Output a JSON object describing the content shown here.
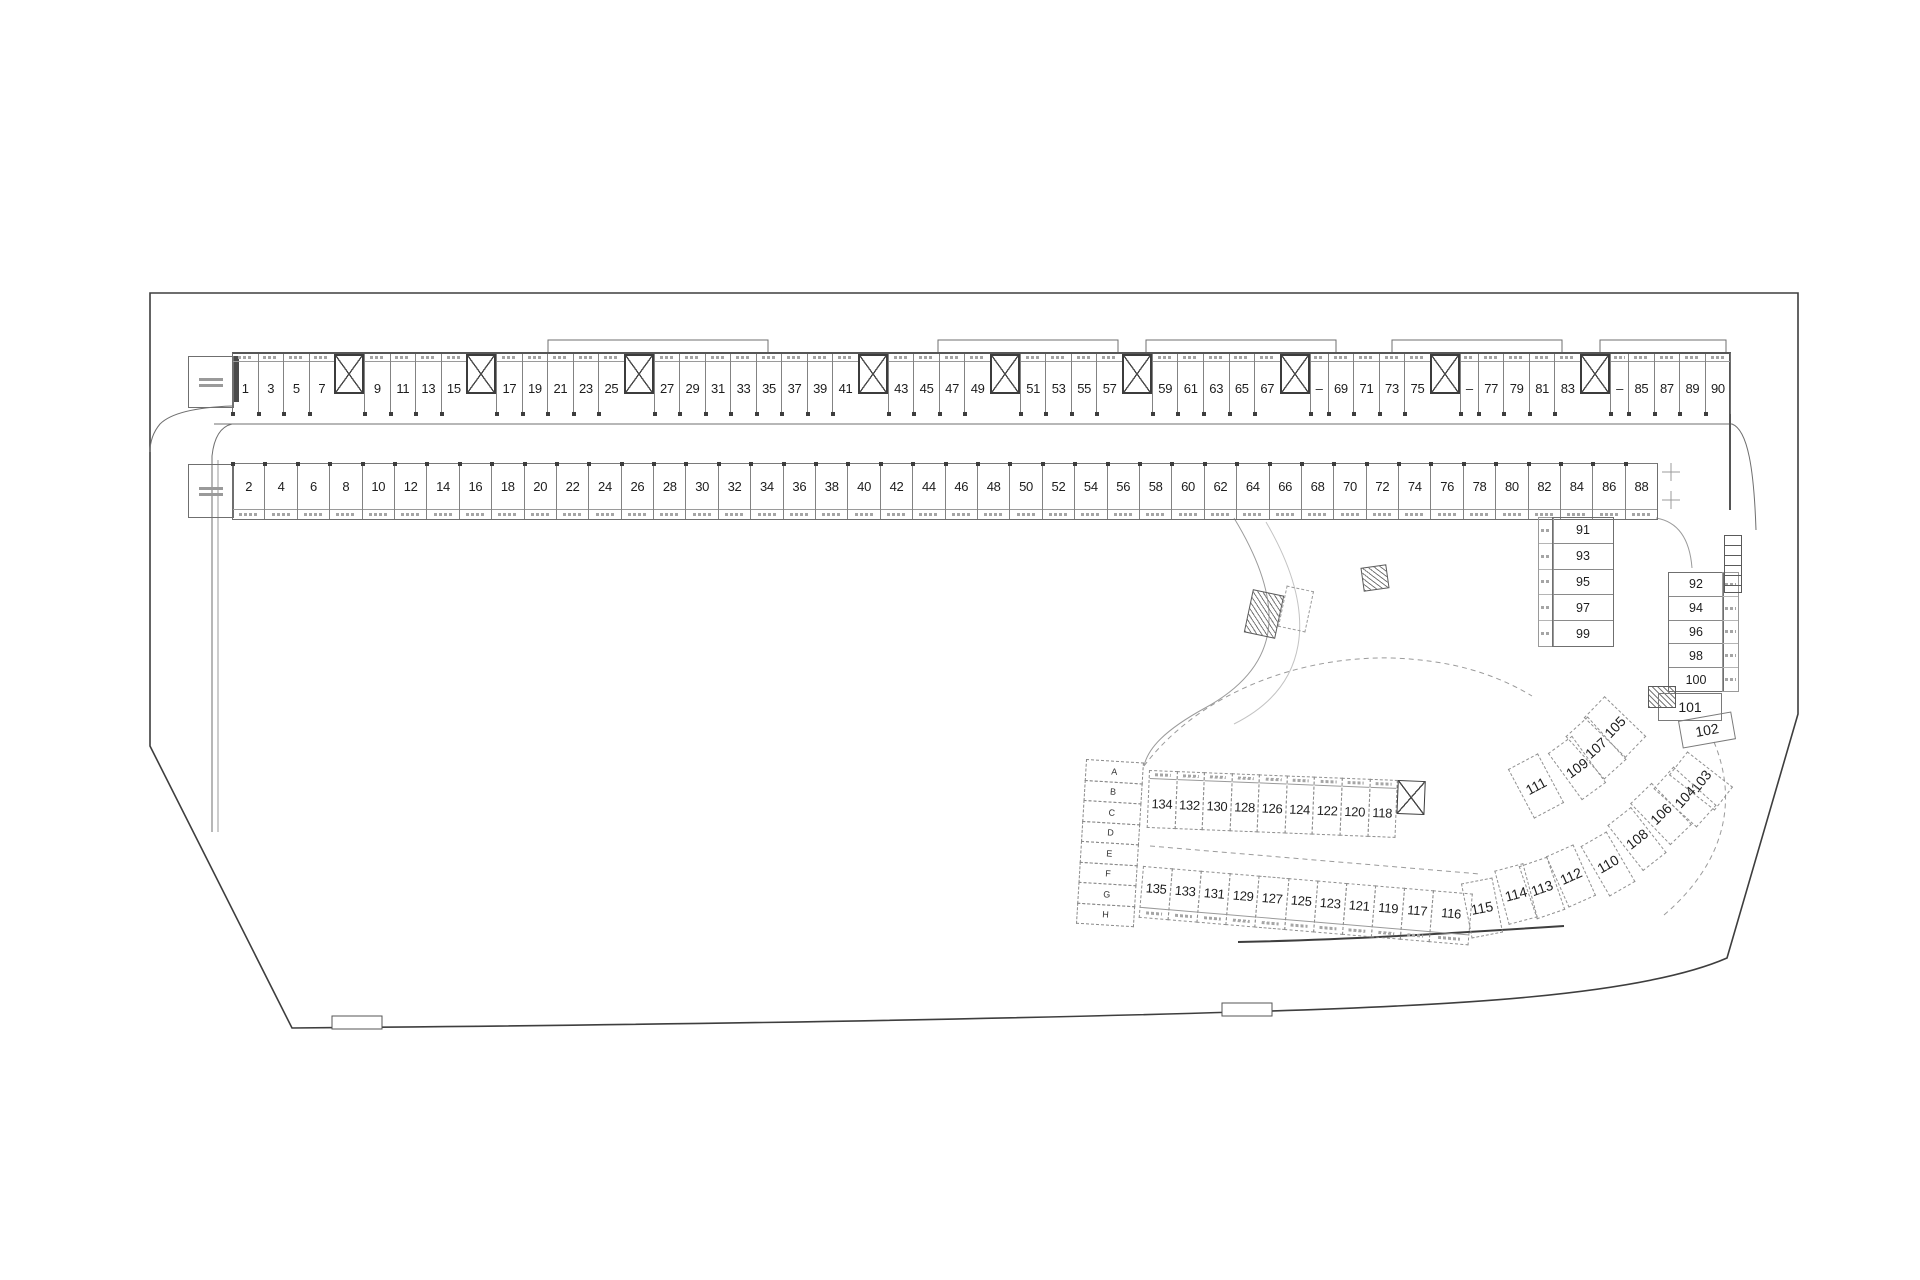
{
  "colors": {
    "boundary": "#3e3e3e",
    "wall": "#6f6f6f",
    "faint": "#9b9b9b",
    "text": "#1d1d1d"
  },
  "top_row": {
    "cells": [
      {
        "t": "s",
        "n": "1"
      },
      {
        "t": "s",
        "n": "3"
      },
      {
        "t": "s",
        "n": "5"
      },
      {
        "t": "s",
        "n": "7"
      },
      {
        "t": "c"
      },
      {
        "t": "s",
        "n": "9"
      },
      {
        "t": "s",
        "n": "11"
      },
      {
        "t": "s",
        "n": "13"
      },
      {
        "t": "s",
        "n": "15"
      },
      {
        "t": "c"
      },
      {
        "t": "s",
        "n": "17"
      },
      {
        "t": "s",
        "n": "19"
      },
      {
        "t": "s",
        "n": "21"
      },
      {
        "t": "s",
        "n": "23"
      },
      {
        "t": "s",
        "n": "25"
      },
      {
        "t": "c"
      },
      {
        "t": "s",
        "n": "27"
      },
      {
        "t": "s",
        "n": "29"
      },
      {
        "t": "s",
        "n": "31"
      },
      {
        "t": "s",
        "n": "33"
      },
      {
        "t": "s",
        "n": "35"
      },
      {
        "t": "s",
        "n": "37"
      },
      {
        "t": "s",
        "n": "39"
      },
      {
        "t": "s",
        "n": "41"
      },
      {
        "t": "c"
      },
      {
        "t": "s",
        "n": "43"
      },
      {
        "t": "s",
        "n": "45"
      },
      {
        "t": "s",
        "n": "47"
      },
      {
        "t": "s",
        "n": "49"
      },
      {
        "t": "c"
      },
      {
        "t": "s",
        "n": "51"
      },
      {
        "t": "s",
        "n": "53"
      },
      {
        "t": "s",
        "n": "55"
      },
      {
        "t": "s",
        "n": "57"
      },
      {
        "t": "c"
      },
      {
        "t": "s",
        "n": "59"
      },
      {
        "t": "s",
        "n": "61"
      },
      {
        "t": "s",
        "n": "63"
      },
      {
        "t": "s",
        "n": "65"
      },
      {
        "t": "s",
        "n": "67"
      },
      {
        "t": "c"
      },
      {
        "t": "d",
        "n": "–"
      },
      {
        "t": "s",
        "n": "69"
      },
      {
        "t": "s",
        "n": "71"
      },
      {
        "t": "s",
        "n": "73"
      },
      {
        "t": "s",
        "n": "75"
      },
      {
        "t": "c"
      },
      {
        "t": "d",
        "n": "–"
      },
      {
        "t": "s",
        "n": "77"
      },
      {
        "t": "s",
        "n": "79"
      },
      {
        "t": "s",
        "n": "81"
      },
      {
        "t": "s",
        "n": "83"
      },
      {
        "t": "c"
      },
      {
        "t": "d",
        "n": "–"
      },
      {
        "t": "s",
        "n": "85"
      },
      {
        "t": "s",
        "n": "87"
      },
      {
        "t": "s",
        "n": "89"
      },
      {
        "t": "s",
        "n": "90"
      }
    ]
  },
  "bottom_row": {
    "cells": [
      "2",
      "4",
      "6",
      "8",
      "10",
      "12",
      "14",
      "16",
      "18",
      "20",
      "22",
      "24",
      "26",
      "28",
      "30",
      "32",
      "34",
      "36",
      "38",
      "40",
      "42",
      "44",
      "46",
      "48",
      "50",
      "52",
      "54",
      "56",
      "58",
      "60",
      "62",
      "64",
      "66",
      "68",
      "70",
      "72",
      "74",
      "76",
      "78",
      "80",
      "82",
      "84",
      "86",
      "88"
    ]
  },
  "stack_left": {
    "cells": [
      "91",
      "93",
      "95",
      "97",
      "99"
    ]
  },
  "stack_right": {
    "cells": [
      "92",
      "94",
      "96",
      "98",
      "100"
    ]
  },
  "cluster": {
    "items": [
      {
        "n": "101",
        "x": 1690,
        "y": 707,
        "w": 64,
        "h": 28,
        "r": 0,
        "solid": true
      },
      {
        "n": "102",
        "x": 1707,
        "y": 730,
        "w": 54,
        "h": 28,
        "r": -10,
        "solid": true
      },
      {
        "n": "103",
        "x": 1701,
        "y": 781,
        "w": 30,
        "h": 58,
        "r": -52
      },
      {
        "n": "104",
        "x": 1685,
        "y": 797,
        "w": 30,
        "h": 58,
        "r": -48
      },
      {
        "n": "105",
        "x": 1615,
        "y": 727,
        "w": 30,
        "h": 58,
        "r": -46
      },
      {
        "n": "106",
        "x": 1661,
        "y": 814,
        "w": 30,
        "h": 58,
        "r": -44
      },
      {
        "n": "107",
        "x": 1596,
        "y": 748,
        "w": 30,
        "h": 58,
        "r": -42
      },
      {
        "n": "108",
        "x": 1637,
        "y": 839,
        "w": 30,
        "h": 58,
        "r": -38
      },
      {
        "n": "109",
        "x": 1577,
        "y": 768,
        "w": 30,
        "h": 58,
        "r": -36
      },
      {
        "n": "110",
        "x": 1608,
        "y": 864,
        "w": 30,
        "h": 58,
        "r": -30
      },
      {
        "n": "111",
        "x": 1536,
        "y": 786,
        "w": 34,
        "h": 56,
        "r": -28
      },
      {
        "n": "112",
        "x": 1571,
        "y": 876,
        "w": 30,
        "h": 56,
        "r": -24
      },
      {
        "n": "113",
        "x": 1542,
        "y": 888,
        "w": 30,
        "h": 56,
        "r": -19
      },
      {
        "n": "114",
        "x": 1516,
        "y": 894,
        "w": 30,
        "h": 56,
        "r": -15
      },
      {
        "n": "115",
        "x": 1482,
        "y": 908,
        "w": 32,
        "h": 56,
        "r": -11
      }
    ]
  },
  "block_upper": {
    "cells": [
      "134",
      "132",
      "130",
      "128",
      "126",
      "124",
      "122",
      "120",
      "118"
    ]
  },
  "block_lower": {
    "cells": [
      "135",
      "133",
      "131",
      "129",
      "127",
      "125",
      "123",
      "121",
      "119",
      "117",
      "116"
    ]
  },
  "letters": [
    "A",
    "B",
    "C",
    "D",
    "E",
    "F",
    "G",
    "H"
  ]
}
